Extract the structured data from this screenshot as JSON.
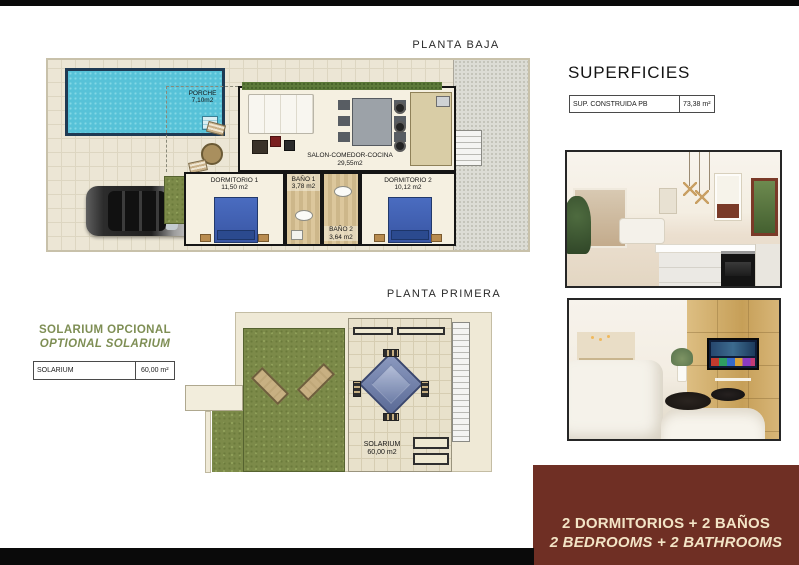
{
  "colors": {
    "banner_bg": "#6F2F24",
    "banner_text": "#F3E4C6",
    "olive_text": "#7E8E54",
    "black_bar": "#0A0A0A",
    "pool_blue": "#57C2D8",
    "grass_green": "#7C8A49",
    "plan_beige": "#ECE6D5"
  },
  "ground_floor": {
    "title": "PLANTA BAJA",
    "rooms": {
      "porche": {
        "name": "PORCHE",
        "area": "7,10m2"
      },
      "salon": {
        "name": "SALON-COMEDOR-COCINA",
        "area": "29,55m2"
      },
      "dormitorio1": {
        "name": "DORMITORIO 1",
        "area": "11,50 m2"
      },
      "bano1": {
        "name": "BAÑO 1",
        "area": "3,78 m2"
      },
      "bano2": {
        "name": "BAÑO 2",
        "area": "3,64 m2"
      },
      "dormitorio2": {
        "name": "DORMITORIO 2",
        "area": "10,12 m2"
      }
    }
  },
  "first_floor": {
    "title": "PLANTA PRIMERA",
    "rooms": {
      "solarium": {
        "name": "SOLARIUM",
        "area": "60,00 m2"
      }
    }
  },
  "superficies": {
    "title": "SUPERFICIES",
    "rows": [
      {
        "label": "SUP. CONSTRUIDA PB",
        "value": "73,38 m²"
      }
    ]
  },
  "solarium_optional": {
    "title_es": "SOLARIUM OPCIONAL",
    "title_en": "OPTIONAL SOLARIUM",
    "rows": [
      {
        "label": "SOLARIUM",
        "value": "60,00 m²"
      }
    ]
  },
  "banner": {
    "line_es": "2 DORMITORIOS + 2 BAÑOS",
    "line_en": "2 BEDROOMS + 2 BATHROOMS"
  }
}
